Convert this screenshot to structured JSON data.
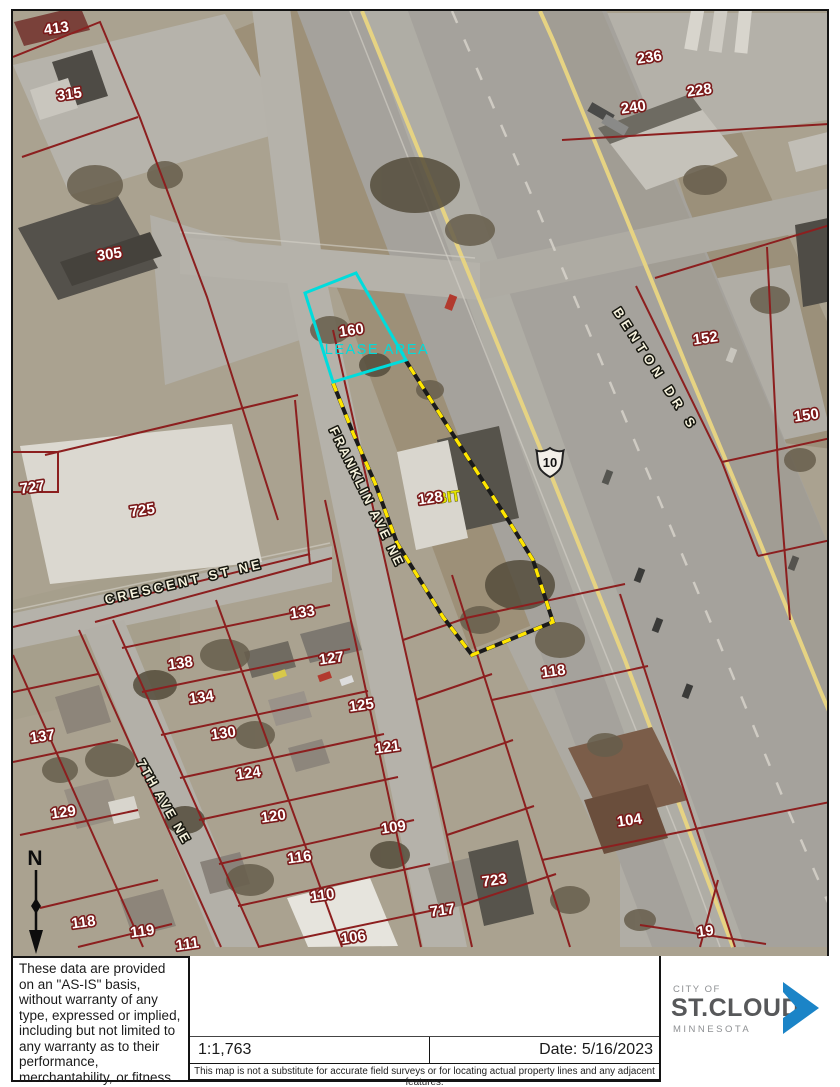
{
  "map": {
    "lease_area_label": "LEASE AREA",
    "highway_shield": "10",
    "north_label": "N",
    "parcel_labels": [
      {
        "t": "413",
        "x": 57,
        "y": 33
      },
      {
        "t": "315",
        "x": 70,
        "y": 99
      },
      {
        "t": "305",
        "x": 110,
        "y": 259
      },
      {
        "t": "236",
        "x": 650,
        "y": 62
      },
      {
        "t": "228",
        "x": 700,
        "y": 95
      },
      {
        "t": "240",
        "x": 634,
        "y": 112
      },
      {
        "t": "152",
        "x": 706,
        "y": 343
      },
      {
        "t": "150",
        "x": 807,
        "y": 420
      },
      {
        "t": "727",
        "x": 33,
        "y": 492
      },
      {
        "t": "725",
        "x": 143,
        "y": 515
      },
      {
        "t": "160",
        "x": 352,
        "y": 335
      },
      {
        "t": "BIT",
        "x": 449,
        "y": 502,
        "c": "ylabel"
      },
      {
        "t": "128",
        "x": 431,
        "y": 503
      },
      {
        "t": "118",
        "x": 554,
        "y": 676
      },
      {
        "t": "133",
        "x": 303,
        "y": 617
      },
      {
        "t": "127",
        "x": 332,
        "y": 663
      },
      {
        "t": "125",
        "x": 362,
        "y": 710
      },
      {
        "t": "121",
        "x": 388,
        "y": 752
      },
      {
        "t": "109",
        "x": 394,
        "y": 832
      },
      {
        "t": "116",
        "x": 300,
        "y": 862
      },
      {
        "t": "110",
        "x": 323,
        "y": 900
      },
      {
        "t": "106",
        "x": 354,
        "y": 942
      },
      {
        "t": "138",
        "x": 181,
        "y": 668
      },
      {
        "t": "134",
        "x": 202,
        "y": 702
      },
      {
        "t": "130",
        "x": 224,
        "y": 738
      },
      {
        "t": "124",
        "x": 249,
        "y": 778
      },
      {
        "t": "120",
        "x": 274,
        "y": 821
      },
      {
        "t": "137",
        "x": 43,
        "y": 741
      },
      {
        "t": "129",
        "x": 64,
        "y": 817
      },
      {
        "t": "118",
        "x": 84,
        "y": 927
      },
      {
        "t": "119",
        "x": 143,
        "y": 936
      },
      {
        "t": "111",
        "x": 188,
        "y": 949
      },
      {
        "t": "717",
        "x": 443,
        "y": 915
      },
      {
        "t": "723",
        "x": 495,
        "y": 885
      },
      {
        "t": "104",
        "x": 630,
        "y": 825
      },
      {
        "t": "19",
        "x": 706,
        "y": 936
      }
    ],
    "street_labels": [
      {
        "t": "CRESCENT ST NE",
        "x": 185,
        "y": 586,
        "a": -13,
        "ls": 3.5
      },
      {
        "t": "FRANKLIN AVE NE",
        "x": 363,
        "y": 499,
        "a": 64,
        "ls": 2.5
      },
      {
        "t": "7TH AVE NE",
        "x": 160,
        "y": 804,
        "a": 60,
        "ls": 2
      },
      {
        "t": "BENTON DR S",
        "x": 652,
        "y": 372,
        "a": 57,
        "ls": 5
      }
    ]
  },
  "footer": {
    "disclaimer": "These data are provided on an \"AS-IS\" basis, without warranty of any type, expressed or implied, including but not limited to any warranty as to their performance, merchantability, or fitness for any particular purpose.",
    "scale": "1:1,763",
    "date": "Date: 5/16/2023",
    "note": "This map is not a substitute for accurate field surveys or for locating actual property lines and any adjacent features.",
    "logo": {
      "city_of": "CITY OF",
      "name": "ST.CLOUD",
      "state": "MINNESOTA"
    }
  },
  "colors": {
    "lease_cyan": "#00dcdc",
    "parcel_line": "#8c1f1f",
    "survey_yellow": "#ffe600",
    "label_fill": "#ffffff",
    "label_halo": "#7a1a1a",
    "logo_blue": "#1b84c7"
  }
}
